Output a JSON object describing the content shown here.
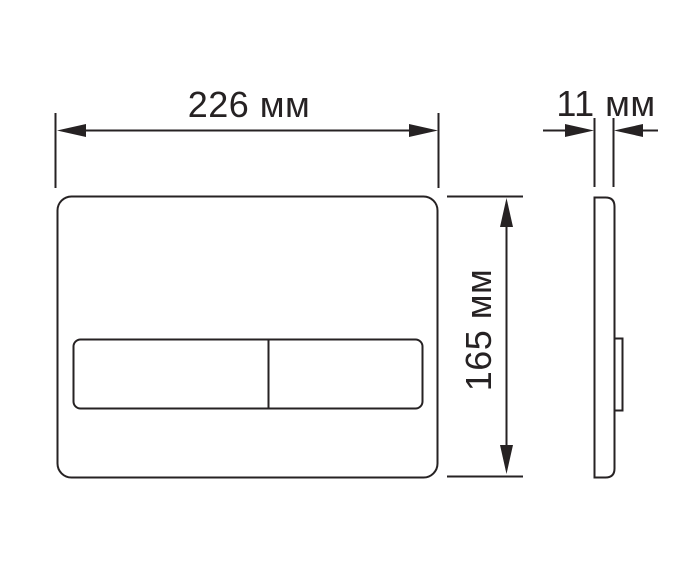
{
  "diagram": {
    "type": "technical-dimension-drawing",
    "subject": "rectangular flush plate, front and side orthographic views",
    "colors": {
      "line": "#262223",
      "background": "#ffffff"
    },
    "dimensions": {
      "width": {
        "label": "226 мм",
        "value": 226,
        "unit": "мм"
      },
      "height": {
        "label": "165 мм",
        "value": 165,
        "unit": "мм"
      },
      "depth": {
        "label": "11 мм",
        "value": 11,
        "unit": "мм"
      }
    }
  }
}
